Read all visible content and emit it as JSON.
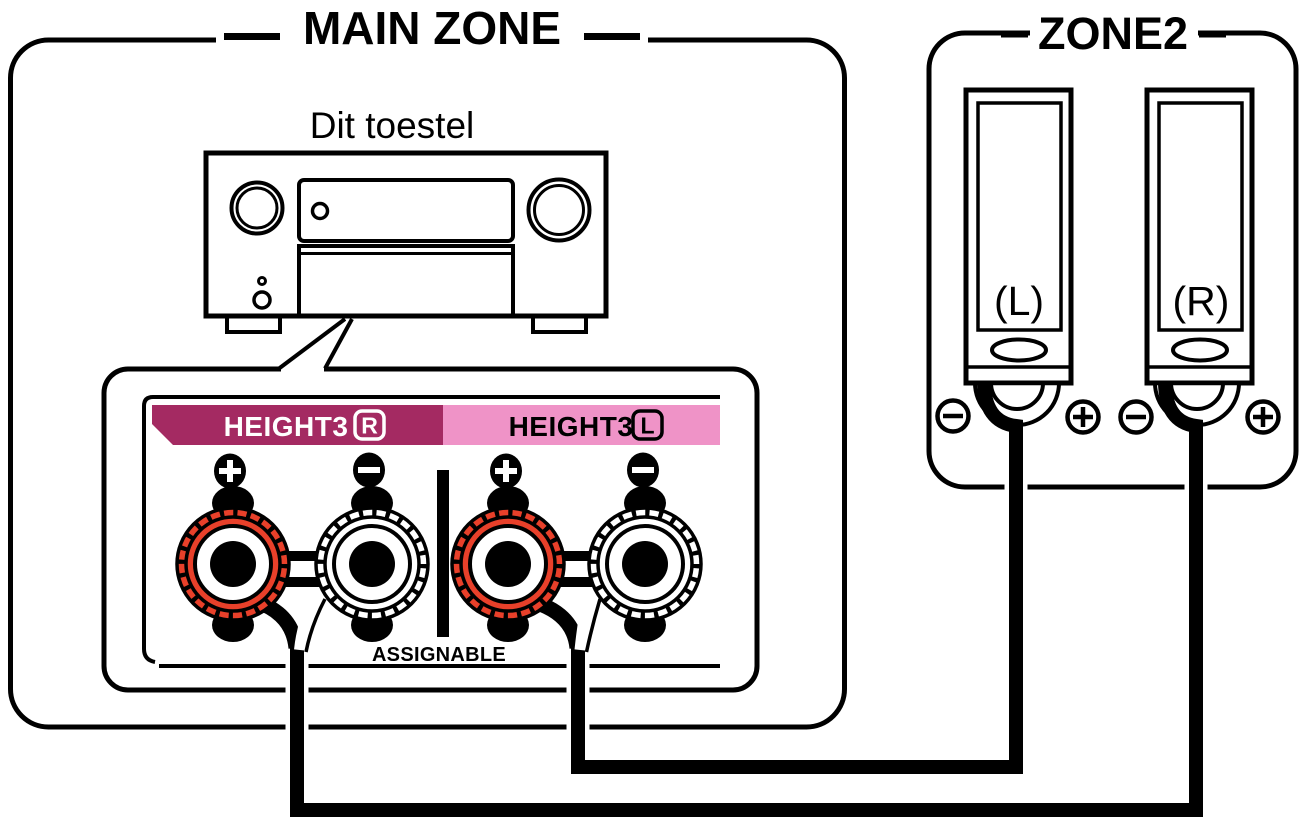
{
  "main_zone": {
    "title": "MAIN ZONE",
    "device_label": "Dit toestel",
    "terminal_panel": {
      "height3_r": {
        "name": "HEIGHT3",
        "channel": "R"
      },
      "height3_l": {
        "name": "HEIGHT3",
        "channel": "L"
      },
      "assignable_label": "ASSIGNABLE",
      "terminals": [
        {
          "pair": "HEIGHT3 R",
          "polarity": "+",
          "color": "red"
        },
        {
          "pair": "HEIGHT3 R",
          "polarity": "−",
          "color": "white"
        },
        {
          "pair": "HEIGHT3 L",
          "polarity": "+",
          "color": "red"
        },
        {
          "pair": "HEIGHT3 L",
          "polarity": "−",
          "color": "white"
        }
      ]
    }
  },
  "zone2": {
    "title": "ZONE2",
    "speakers": [
      {
        "label": "(L)",
        "minus": "−",
        "plus": "+"
      },
      {
        "label": "(R)",
        "minus": "−",
        "plus": "+"
      }
    ]
  },
  "colors": {
    "terminal_red": "#e8402a",
    "label_magenta": "#a42a62",
    "label_pink": "#ef93c7",
    "line_black": "#000000",
    "background": "#ffffff"
  }
}
